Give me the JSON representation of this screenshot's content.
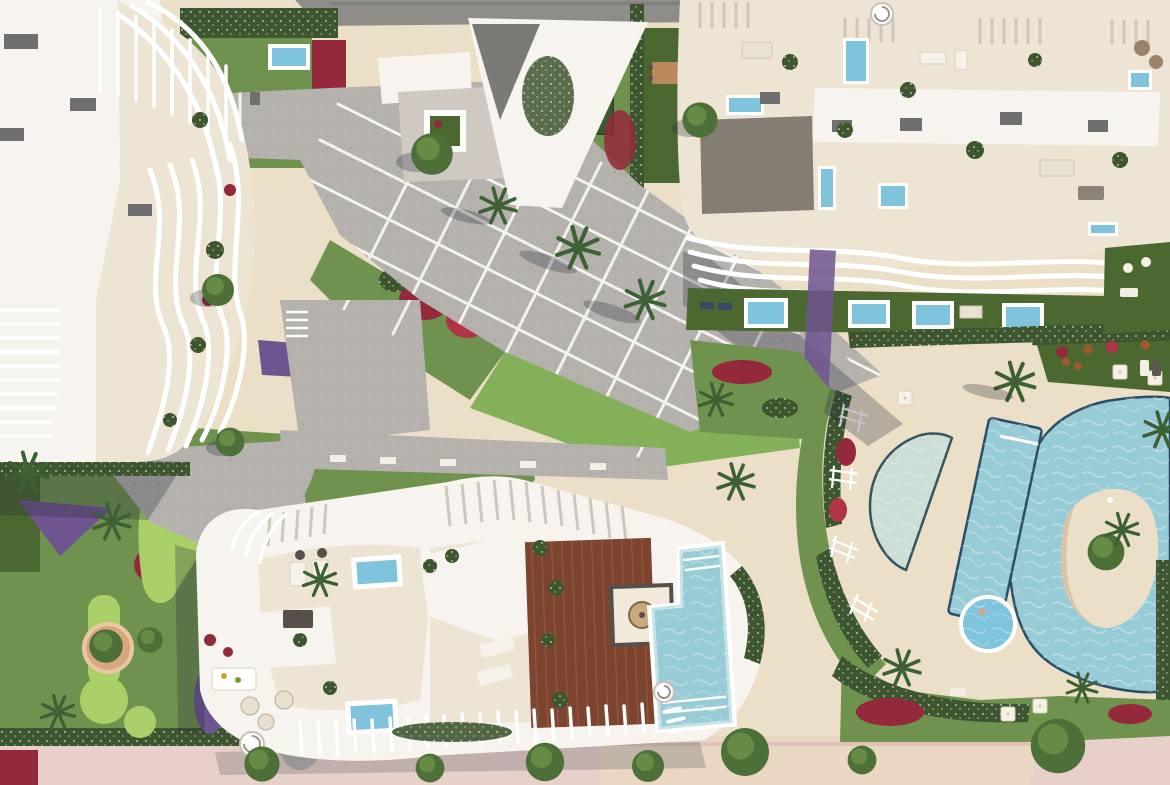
{
  "meta": {
    "title": "Aerial render of a beachfront residential complex",
    "view": "top-down drone render",
    "width": 1170,
    "height": 785,
    "visible_text": []
  },
  "palette": {
    "sandBase": "#ddd1bb",
    "deckSand": "#ecdfc8",
    "deckLight": "#f3ead9",
    "plaza": "#b5b1ad",
    "plazaLine": "#f4f2ee",
    "roadTop": "#8f8d8a",
    "promenade": "#e7d0c9",
    "promenadeRight": "#e9d7c4",
    "lawn": "#6f934f",
    "lawnDark": "#4a682f",
    "lawnBright": "#83b058",
    "golf": "#abd06a",
    "hedge": "#3e5630",
    "hedgeSpeckle": "#cfd8c2",
    "redBed": "#93293b",
    "redBright": "#b03348",
    "purpleBed": "#6f5590",
    "rust": "#9a5a2e",
    "roofWhite": "#f7f4ef",
    "roofShade": "#e2dcd2",
    "cream": "#eee4d4",
    "creamDark": "#e3d6c2",
    "wood": "#7d4430",
    "woodLight": "#975a41",
    "poolWater": "#97cbd6",
    "poolLightW": "#c6e2e4",
    "poolPale": "#ccdfd6",
    "poolDeep": "#2a4e66",
    "poolBright": "#7fc3dc",
    "grayBox": "#6f6f6f",
    "palm": "#3d6134",
    "tree": "#4c7038",
    "treeLight": "#6d9448",
    "shadow": "rgba(35,40,55,0.28)"
  },
  "scene": {
    "buildings": [
      {
        "name": "left-residential-building",
        "feature": "curved white balcony fins, rooftop pergolas, AC units"
      },
      {
        "name": "top-center-roof-wedge",
        "feature": "angular white roof with paved terrace and square planter"
      },
      {
        "name": "right-residential-building",
        "feature": "cream rooftop terraces, 6 small plunge pools, wavy stacked balconies, spiral stair"
      },
      {
        "name": "south-residential-building",
        "feature": "rooftop wooden deck, L-shaped pool, kiosk with parasol, plunge pools, spiral stairs, slatted pergolas"
      }
    ],
    "pools": [
      {
        "name": "lagoon-pool",
        "feature": "freeform pool with central sand island and plants"
      },
      {
        "name": "lap-pool",
        "feature": "slanted rectangular lane pool"
      },
      {
        "name": "half-moon-pool",
        "feature": "D-shaped shallow pool"
      },
      {
        "name": "kids-pool",
        "feature": "small round pool"
      },
      {
        "name": "rooftop-plunge-pools",
        "feature": "small blue pools on both large buildings and private gardens"
      }
    ],
    "landscape": [
      {
        "name": "central-plaza",
        "feature": "diagonal grey paving with white grid joints, stairs, benches"
      },
      {
        "name": "mini-golf-garden",
        "feature": "putting greens, circular planter, winding path, palms"
      },
      {
        "name": "flower-beds",
        "feature": "crimson and purple ground-cover patches"
      },
      {
        "name": "pool-deck",
        "feature": "sandy beach-style deck with white parasols and loungers"
      },
      {
        "name": "promenade",
        "feature": "pink paved walk with street trees along bottom edge"
      },
      {
        "name": "top-road",
        "feature": "grey asphalt road at top edge"
      }
    ]
  }
}
